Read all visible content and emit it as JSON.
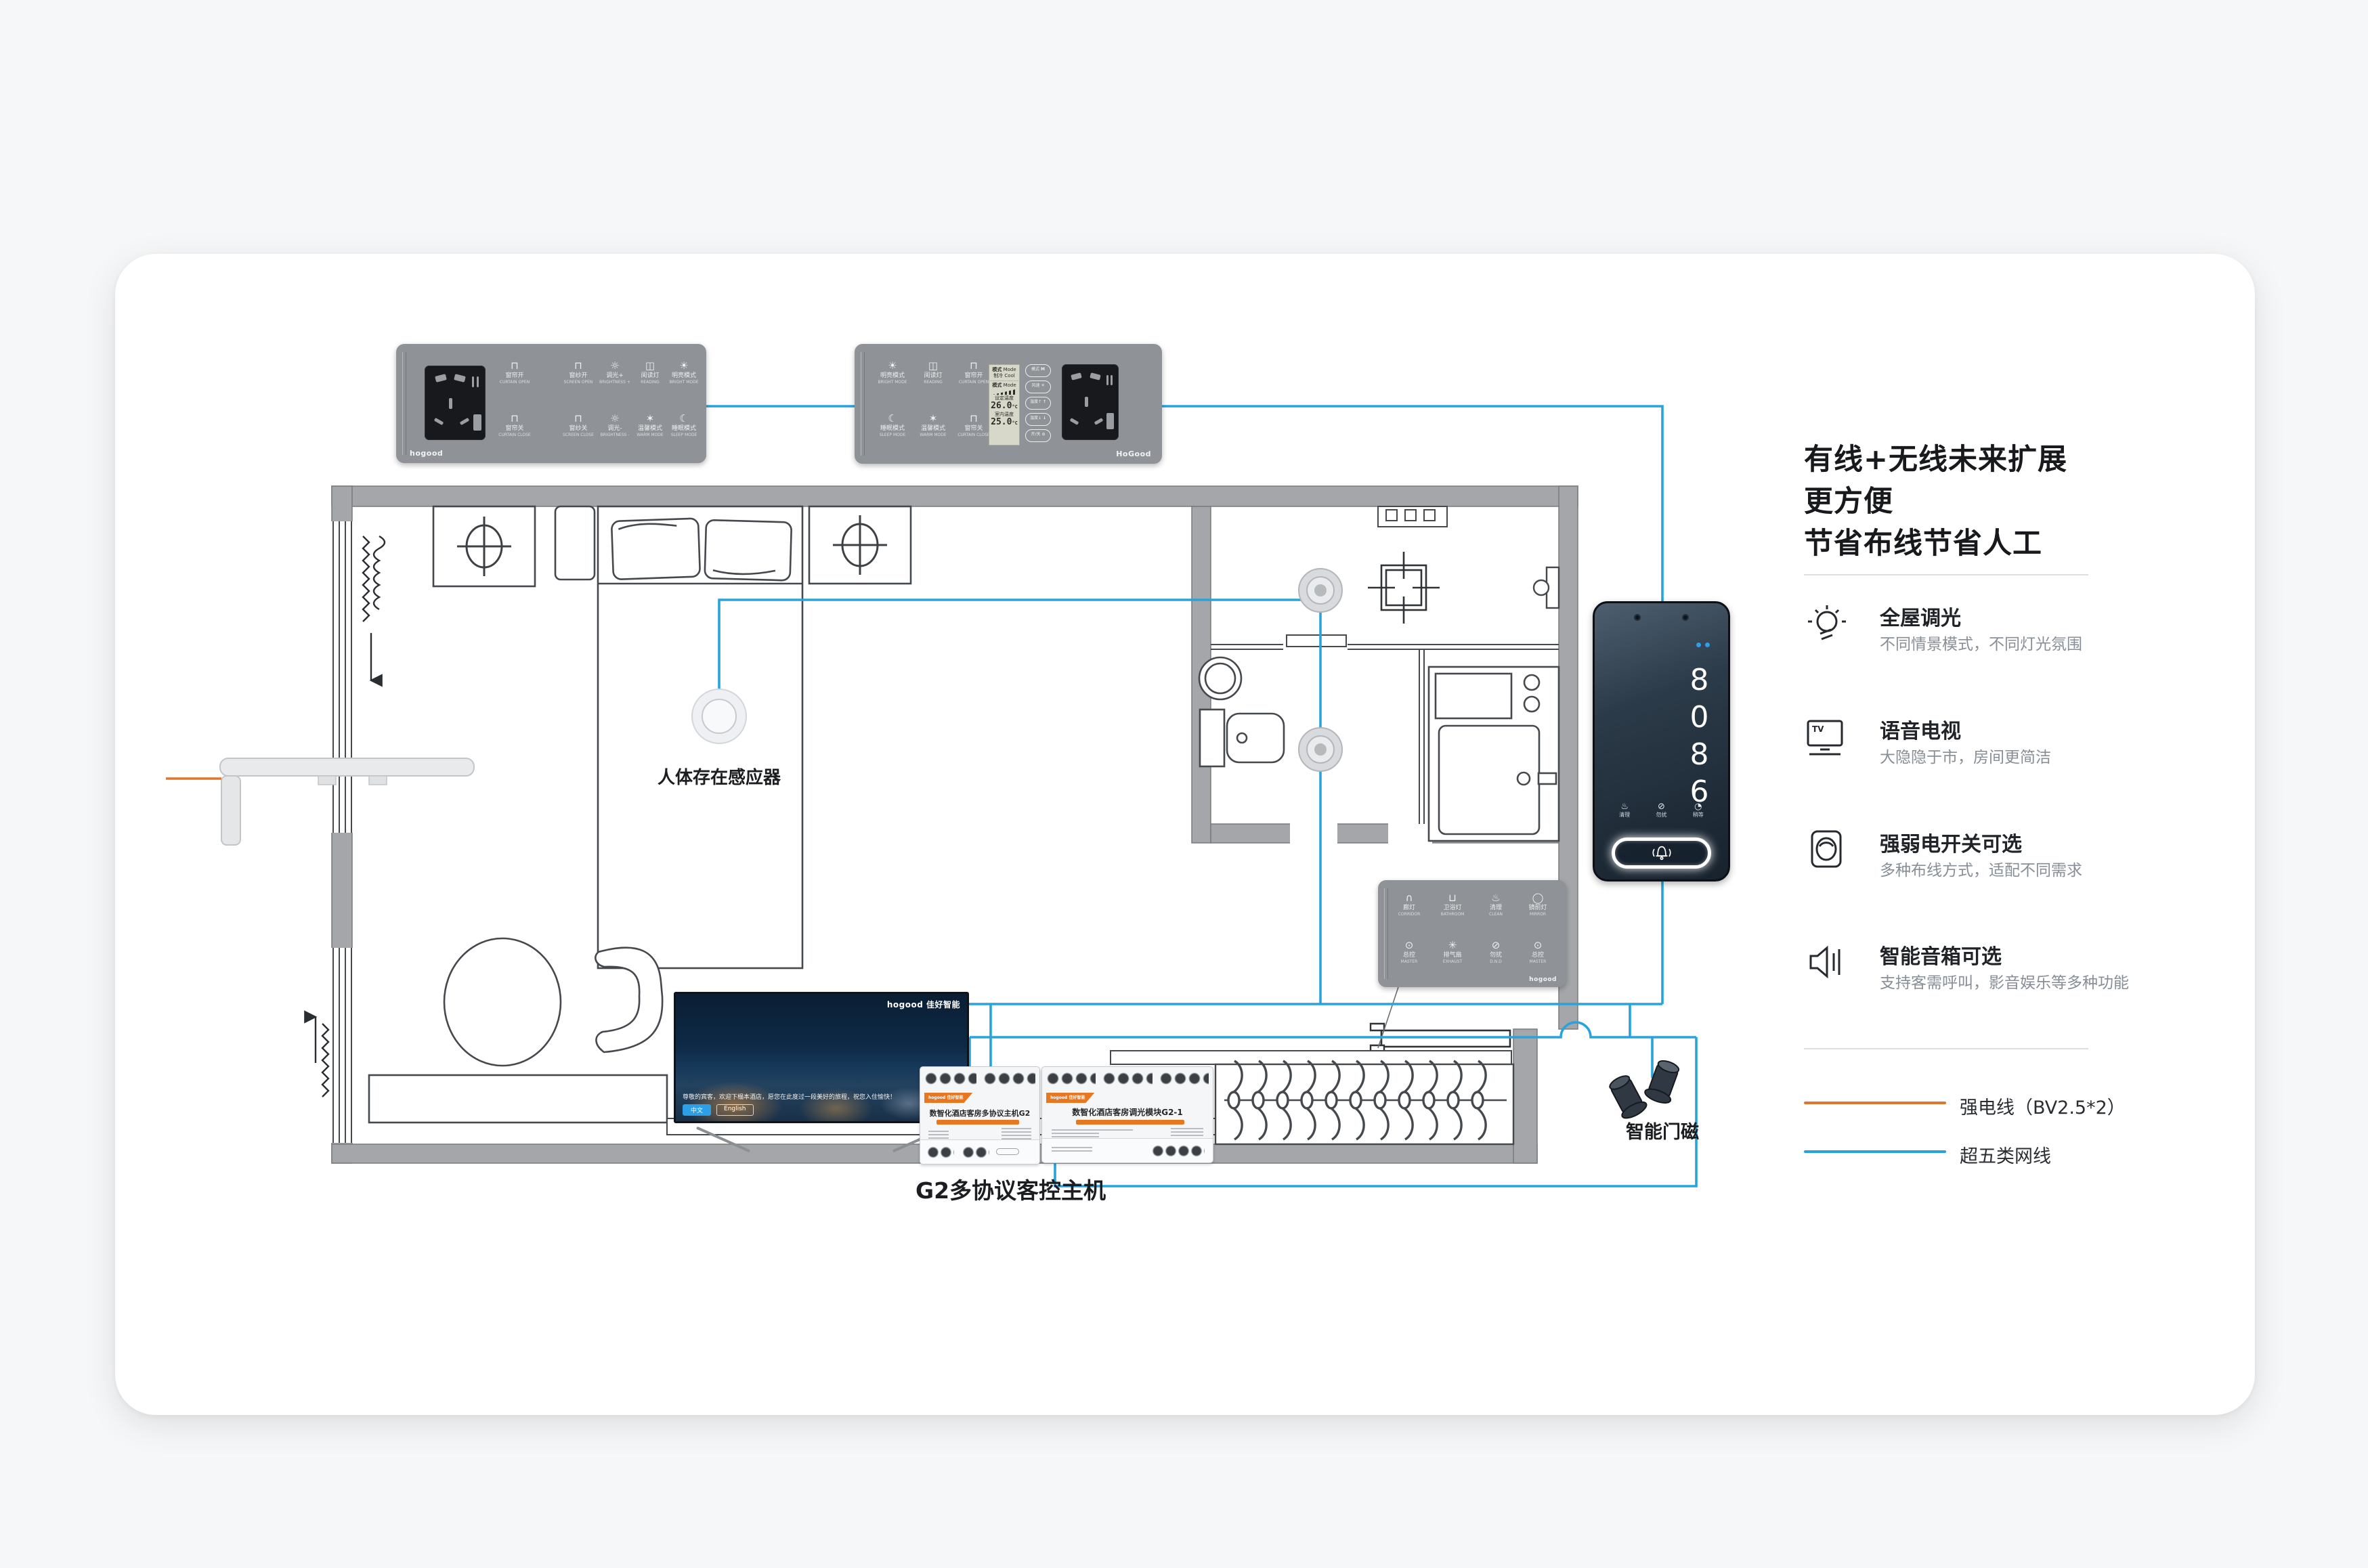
{
  "colors": {
    "wire-strong": "#E0762C",
    "wire-net": "#29A3DC",
    "wall": "#A4A6A9",
    "panel": "#8F9296",
    "accent-orange": "#E87722"
  },
  "info_panel": {
    "title_line1": "有线+无线未来扩展更方便",
    "title_line2": "节省布线节省人工",
    "features": [
      {
        "title": "全屋调光",
        "desc": "不同情景模式，不同灯光氛围"
      },
      {
        "title": "语音电视",
        "desc": "大隐隐于市，房间更简洁"
      },
      {
        "title": "强弱电开关可选",
        "desc": "多种布线方式，适配不同需求"
      },
      {
        "title": "智能音箱可选",
        "desc": "支持客需呼叫，影音娱乐等多种功能"
      }
    ],
    "tv_icon_text": "TV",
    "legend": [
      {
        "label": "强电线（BV2.5*2）"
      },
      {
        "label": "超五类网线"
      }
    ]
  },
  "plan_labels": {
    "presence_sensor": "人体存在感应器",
    "door_magnet": "智能门磁",
    "host": "G2多协议客控主机"
  },
  "panel_entry": {
    "brand": "hogood",
    "rows": [
      [
        {
          "zh": "窗帘开",
          "en": "CURTAIN OPEN",
          "icon": "⊓"
        },
        {
          "zh": "窗纱开",
          "en": "SCREEN OPEN",
          "icon": "⊓"
        },
        {
          "zh": "调光+",
          "en": "BRIGHTNESS +",
          "icon": "☼"
        },
        {
          "zh": "阅读灯",
          "en": "READING",
          "icon": "◫"
        },
        {
          "zh": "明亮模式",
          "en": "BRIGHT MODE",
          "icon": "☀"
        }
      ],
      [
        {
          "zh": "窗帘关",
          "en": "CURTAIN CLOSE",
          "icon": "⊓"
        },
        {
          "zh": "窗纱关",
          "en": "SCREEN CLOSE",
          "icon": "⊓"
        },
        {
          "zh": "调光-",
          "en": "BRIGHTNESS -",
          "icon": "☼"
        },
        {
          "zh": "温馨模式",
          "en": "WARM MODE",
          "icon": "✶"
        },
        {
          "zh": "睡眠模式",
          "en": "SLEEP MODE",
          "icon": "☾"
        }
      ]
    ]
  },
  "panel_thermostat": {
    "brand": "HoGood",
    "left_rows": [
      [
        {
          "zh": "明亮模式",
          "en": "BRIGHT MODE",
          "icon": "☀"
        },
        {
          "zh": "阅读灯",
          "en": "READING",
          "icon": "◫"
        },
        {
          "zh": "窗帘开",
          "en": "CURTAIN OPEN",
          "icon": "⊓"
        }
      ],
      [
        {
          "zh": "睡眠模式",
          "en": "SLEEP MODE",
          "icon": "☾"
        },
        {
          "zh": "温馨模式",
          "en": "WARM MODE",
          "icon": "✶"
        },
        {
          "zh": "窗帘关",
          "en": "CURTAIN CLOSE",
          "icon": "⊓"
        }
      ]
    ],
    "lcd": {
      "mode_zh": "模式",
      "mode_en": "Mode",
      "state": "制冷 Cool",
      "fan_zh": "模式",
      "fan_en": "Mode",
      "set_zh": "设定温度",
      "set_en": "Set temp",
      "set_value": "26.0",
      "room_zh": "室内温度",
      "room_en": "Room temp",
      "room_value": "25.0",
      "unit": "°C"
    },
    "side_buttons": [
      {
        "zh": "模式",
        "icon": "M"
      },
      {
        "zh": "风速",
        "icon": "✳"
      },
      {
        "zh": "温度↑",
        "icon": "↑"
      },
      {
        "zh": "温度↓",
        "icon": "↓"
      },
      {
        "zh": "开/关",
        "icon": "⊙"
      }
    ]
  },
  "panel_bathroom": {
    "brand": "hogood",
    "rows": [
      [
        {
          "zh": "廊灯",
          "en": "CORRIDOR",
          "icon": "∩"
        },
        {
          "zh": "卫浴灯",
          "en": "BATHROOM",
          "icon": "⊔"
        },
        {
          "zh": "清理",
          "en": "CLEAN",
          "icon": "♨"
        },
        {
          "zh": "镜前灯",
          "en": "MIRROR",
          "icon": "◯"
        }
      ],
      [
        {
          "zh": "总控",
          "en": "MASTER",
          "icon": "⊙"
        },
        {
          "zh": "排气扇",
          "en": "EXHAUST",
          "icon": "✳"
        },
        {
          "zh": "勿扰",
          "en": "D.N.D",
          "icon": "⊘"
        },
        {
          "zh": "总控",
          "en": "MASTER",
          "icon": "⊙"
        }
      ]
    ]
  },
  "din_left": {
    "brand": "hogood 佳好智能",
    "title": "数智化酒店客房多协议主机G2"
  },
  "din_right": {
    "brand": "hogood 佳好智能",
    "title": "数智化酒店客房调光模块G2-1"
  },
  "tv": {
    "logo": "hogood 佳好智能",
    "caption": "尊敬的宾客，欢迎下榻本酒店，愿您在此度过一段美好的旅程，祝您入住愉快！",
    "btn_cn": "中文",
    "btn_en": "English"
  },
  "door_phone": {
    "digits": "8086",
    "actions": [
      {
        "zh": "清理",
        "icon": "♨"
      },
      {
        "zh": "勿扰",
        "icon": "⊘"
      },
      {
        "zh": "稍等",
        "icon": "◔"
      }
    ]
  }
}
